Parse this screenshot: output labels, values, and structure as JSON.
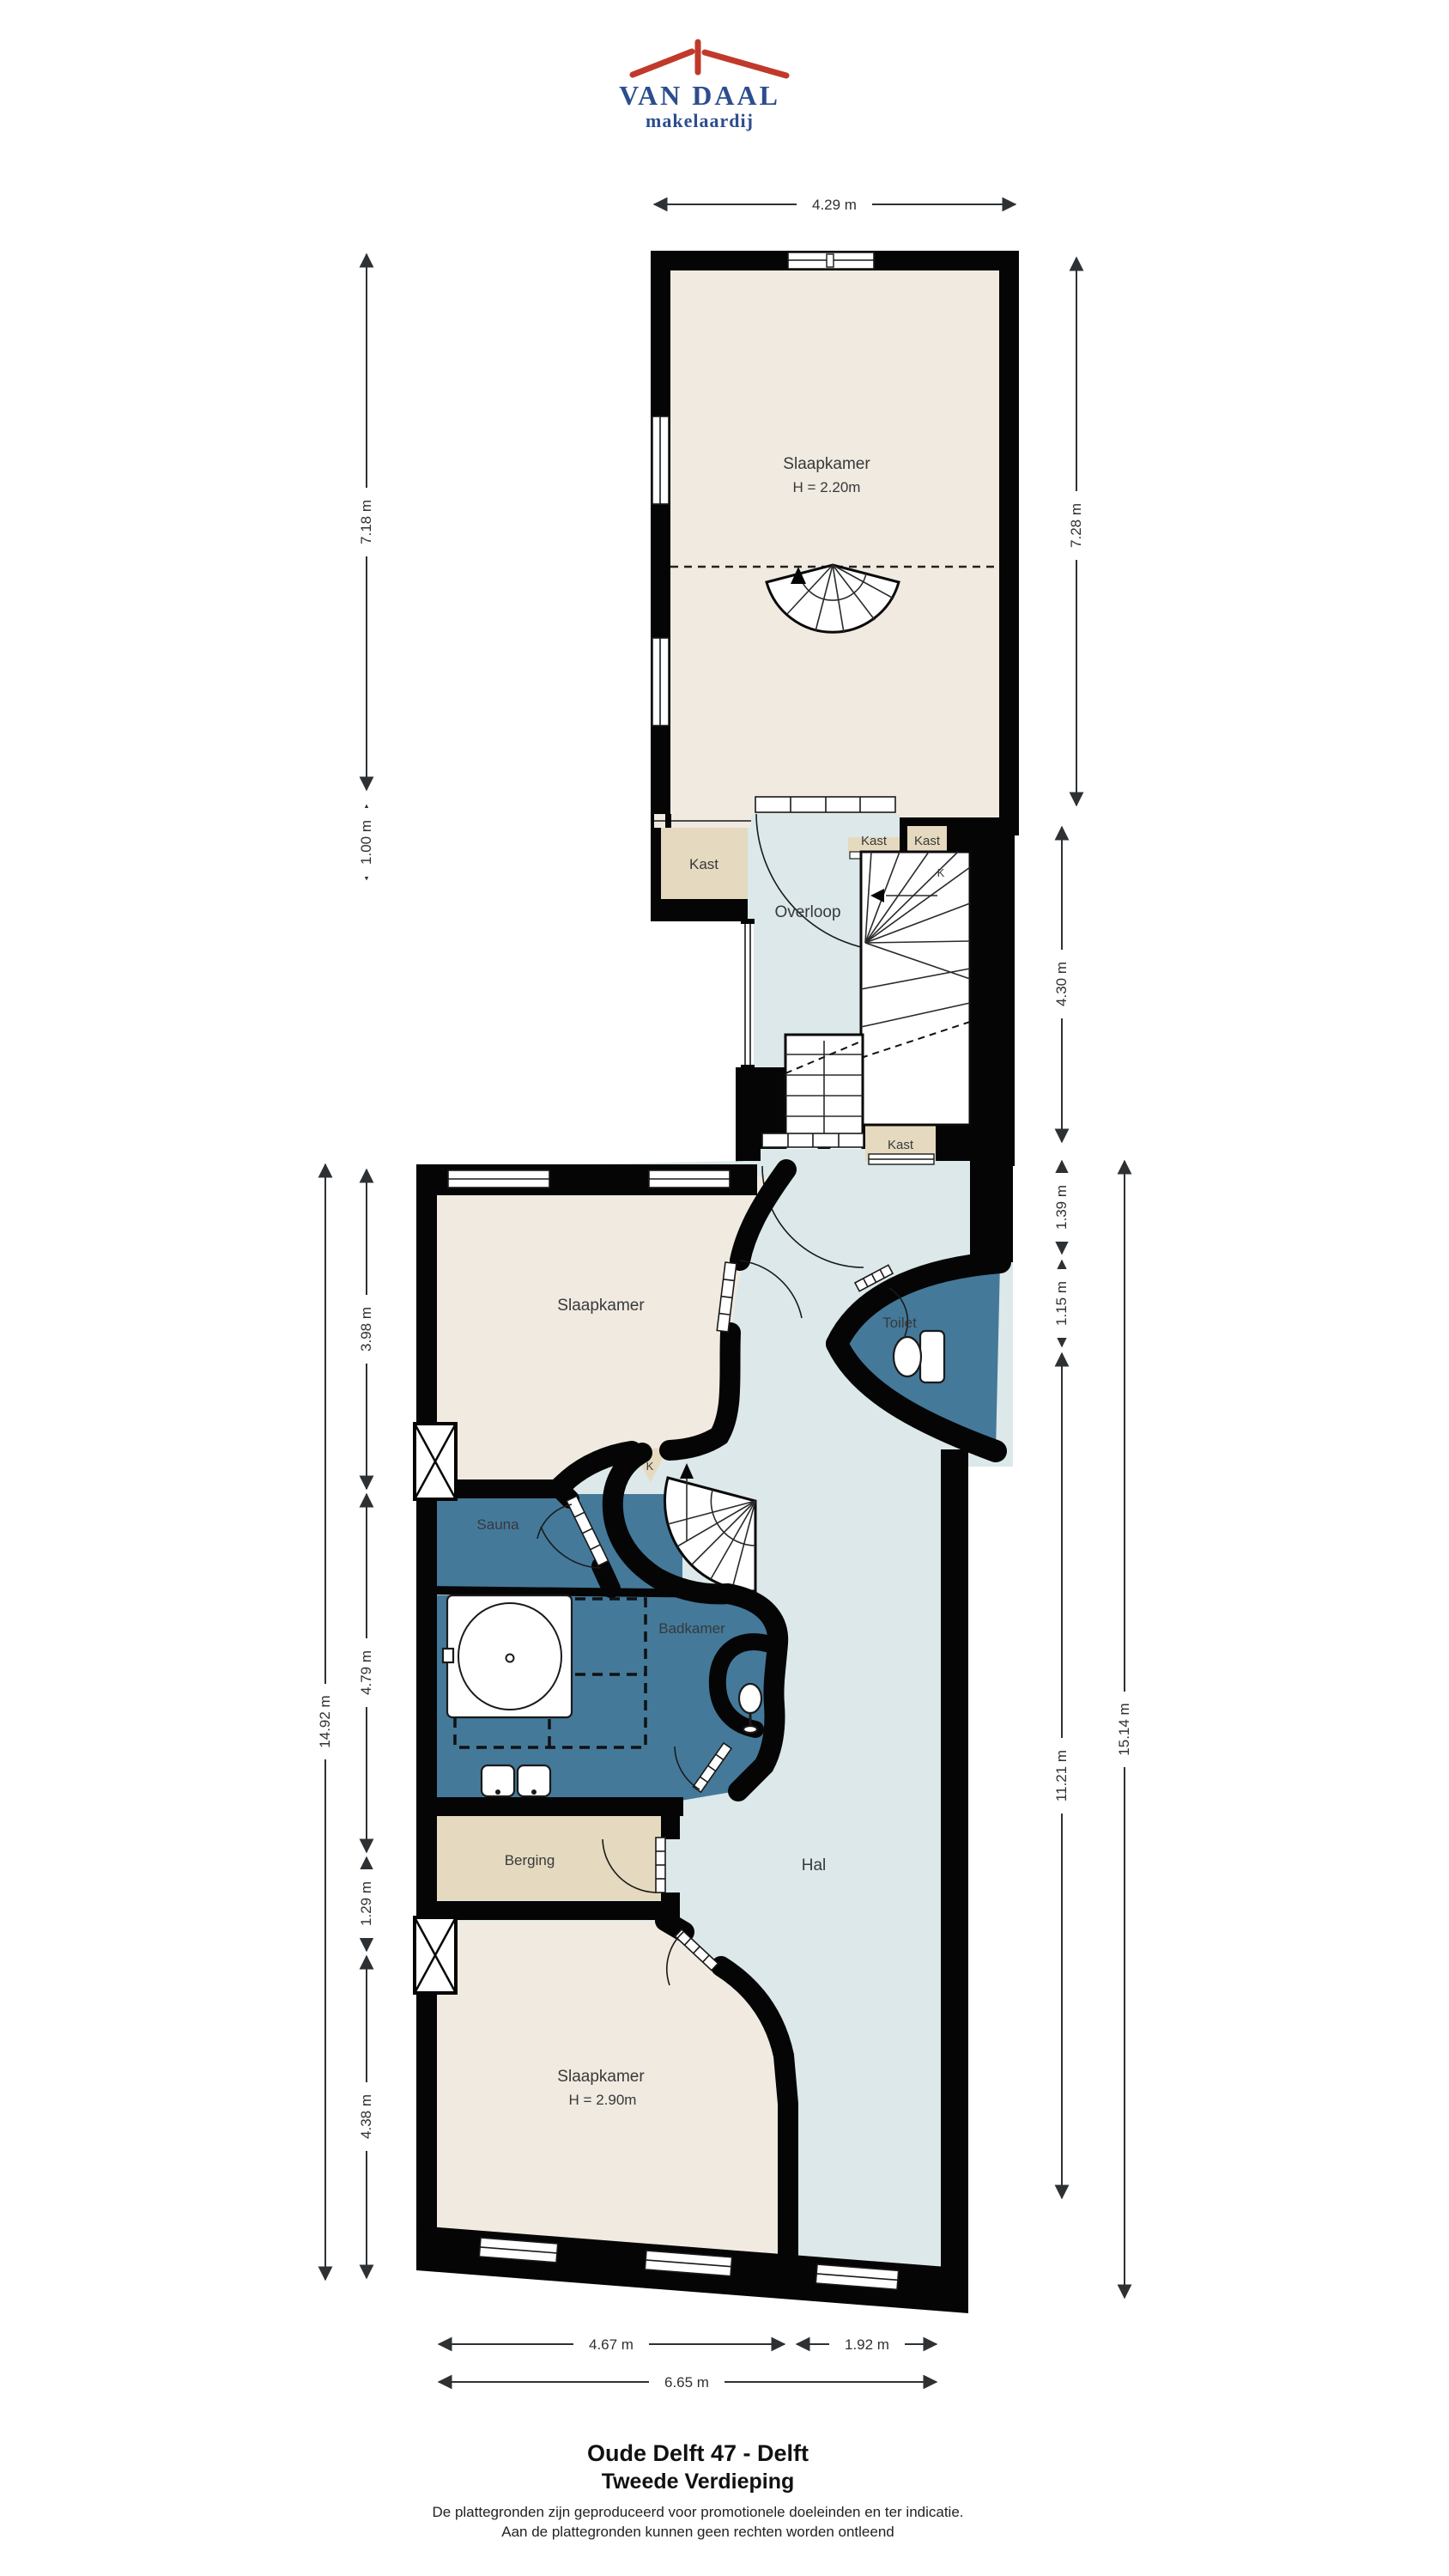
{
  "logo": {
    "line1": "VAN DAAL",
    "line2": "makelaardij",
    "roof_color": "#c0392b",
    "text_color": "#2c4d8e"
  },
  "rooms": {
    "slaapkamer_top": {
      "name": "Slaapkamer",
      "height": "H = 2.20m"
    },
    "kast_left": {
      "name": "Kast"
    },
    "overloop": {
      "name": "Overloop"
    },
    "kast_small_1": {
      "name": "Kast"
    },
    "kast_small_2": {
      "name": "Kast"
    },
    "k_upper": {
      "name": "K"
    },
    "kast_hal": {
      "name": "Kast"
    },
    "slaapkamer_mid": {
      "name": "Slaapkamer"
    },
    "toilet": {
      "name": "Toilet"
    },
    "sauna": {
      "name": "Sauna"
    },
    "k_nook": {
      "name": "K"
    },
    "badkamer": {
      "name": "Badkamer"
    },
    "berging": {
      "name": "Berging"
    },
    "hal": {
      "name": "Hal"
    },
    "slaapkamer_bottom": {
      "name": "Slaapkamer",
      "height": "H = 2.90m"
    }
  },
  "dimensions": {
    "top": "4.29 m",
    "upper_left_main": "7.18 m",
    "upper_left_small": "1.00 m",
    "upper_right_main": "7.28 m",
    "stair_right": "4.30 m",
    "lower_left": [
      "3.98 m",
      "4.79 m",
      "1.29 m",
      "4.38 m"
    ],
    "lower_left_total": "14.92 m",
    "lower_right": [
      "1.39 m",
      "1.15 m",
      "11.21 m"
    ],
    "lower_right_total": "15.14 m",
    "bottom_left": "4.67 m",
    "bottom_right": "1.92 m",
    "bottom_total": "6.65 m"
  },
  "footer": {
    "title": "Oude Delft 47 - Delft",
    "subtitle": "Tweede Verdieping",
    "disclaimer1": "De plattegronden zijn geproduceerd voor promotionele doeleinden en ter indicatie.",
    "disclaimer2": "Aan de plattegronden kunnen geen rechten worden ontleend"
  },
  "colors": {
    "walls": "#050505",
    "bedroom_floor": "#f0eae0",
    "closet_floor": "#e5dabf",
    "wet_room_floor": "#44799a",
    "hall_floor": "#dce8e9",
    "label_text": "#37393b"
  }
}
